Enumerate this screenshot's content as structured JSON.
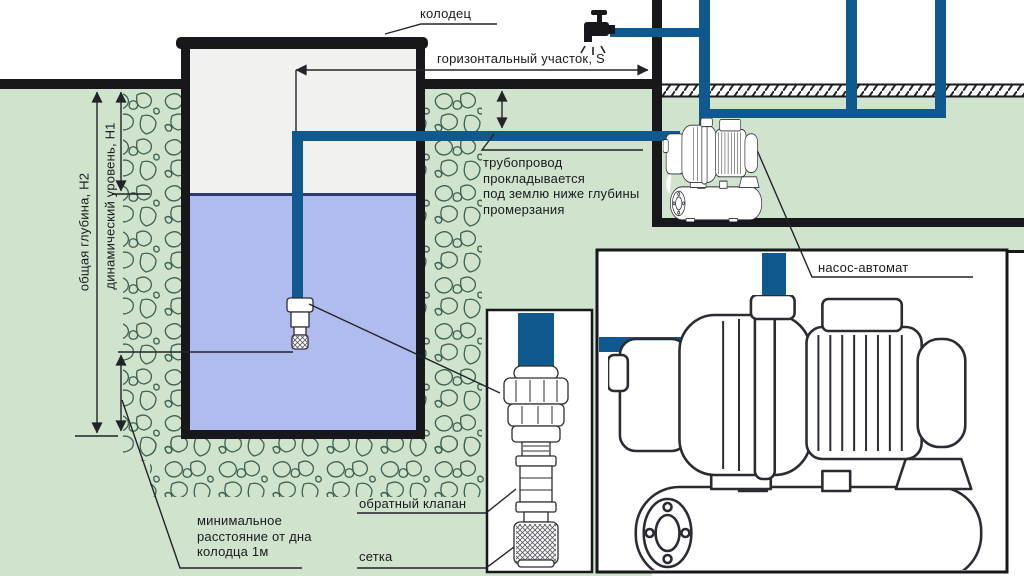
{
  "title": "Схема водоснабжения из колодца с насосом-автоматом",
  "labels": {
    "well": "колодец",
    "horizontal_section": "горизонтальный участок, S",
    "pipeline_note": "трубопровод\nпрокладывается\nпод землю ниже глубины\nпромерзания",
    "pump_station": "насос-автомат",
    "check_valve": "обратный клапан",
    "strainer": "сетка",
    "min_distance": "минимальное\nрасстояние от дна\nколодца 1м",
    "total_depth": "общая глубина, Н2",
    "dynamic_level": "динамический уровень, Н1"
  },
  "colors": {
    "pipe_blue": "#10598e",
    "water": "#b1bcee",
    "waterline": "#2c3a6e",
    "earth_green": "#cfe3cd",
    "structure_black": "#17171c",
    "stone_stroke": "#3f6052",
    "drawing_stroke": "#2b2b33"
  }
}
